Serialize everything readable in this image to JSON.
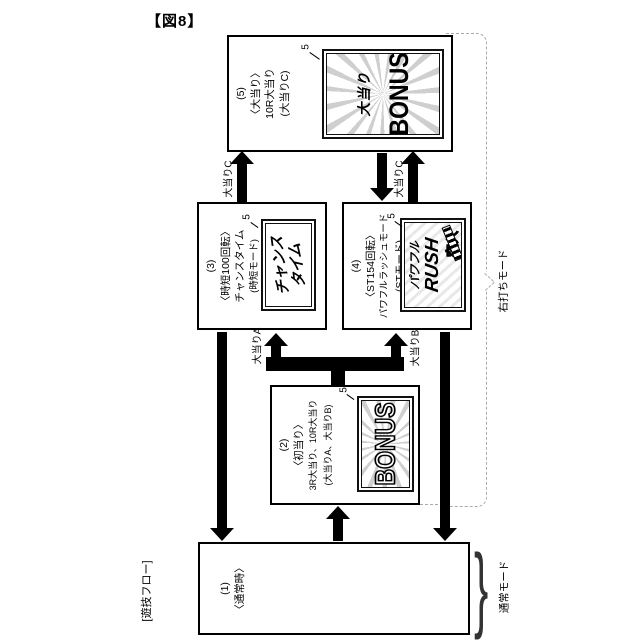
{
  "figure_label": "【図8】",
  "flow_label": "[遊技フロー]",
  "ref_number": "5",
  "boxes": {
    "b5": {
      "id": "(5)",
      "lines": [
        "〈大当り〉",
        "10R大当り",
        "(大当りC)"
      ],
      "screen": {
        "sub": "大当り",
        "main": "BONUS"
      }
    },
    "b3": {
      "id": "(3)",
      "lines": [
        "〈時短100回転〉",
        "チャンスタイム",
        "(時短モード)"
      ],
      "screen": {
        "line1": "チャンス",
        "line2": "タイム"
      }
    },
    "b4": {
      "id": "(4)",
      "lines": [
        "〈ST154回転〉",
        "パワフルラッシュモード",
        "(STモード)"
      ],
      "screen": {
        "line1": "パワフル",
        "line2": "RUSH",
        "line3": "突入"
      }
    },
    "b2": {
      "id": "(2)",
      "lines": [
        "〈初当り〉",
        "3R大当り、10R大当り",
        "(大当りA、大当りB)"
      ],
      "screen": {
        "main": "BONUS"
      }
    },
    "b1": {
      "id": "(1)",
      "lines": [
        "〈通常時〉"
      ]
    }
  },
  "arrow_labels": {
    "c": "大当りC",
    "a": "大当りA",
    "b": "大当りB"
  },
  "mode_labels": {
    "right": "右打ちモード",
    "normal": "通常モード"
  },
  "colors": {
    "line": "#000000",
    "dashed_bracket": "#aaaaaa",
    "screen_ray": "#cfcfcf"
  }
}
